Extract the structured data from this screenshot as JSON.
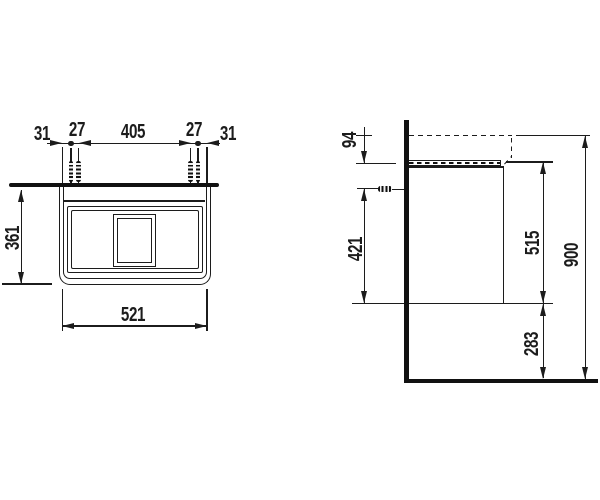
{
  "page": {
    "background": "#ffffff",
    "line_color": "#1c1c1c"
  },
  "drawing": {
    "plan_view": {
      "top_dims": [
        "31",
        "27",
        "405",
        "27",
        "31"
      ],
      "depth_dim": "361",
      "width_dim": "521"
    },
    "side_view": {
      "basin_top_to_cabinet_dim": "94",
      "anchor_to_cabinet_bottom_dim": "421",
      "cabinet_height_dim": "515",
      "cabinet_bottom_to_floor_dim": "283",
      "total_height_dim": "900"
    }
  }
}
